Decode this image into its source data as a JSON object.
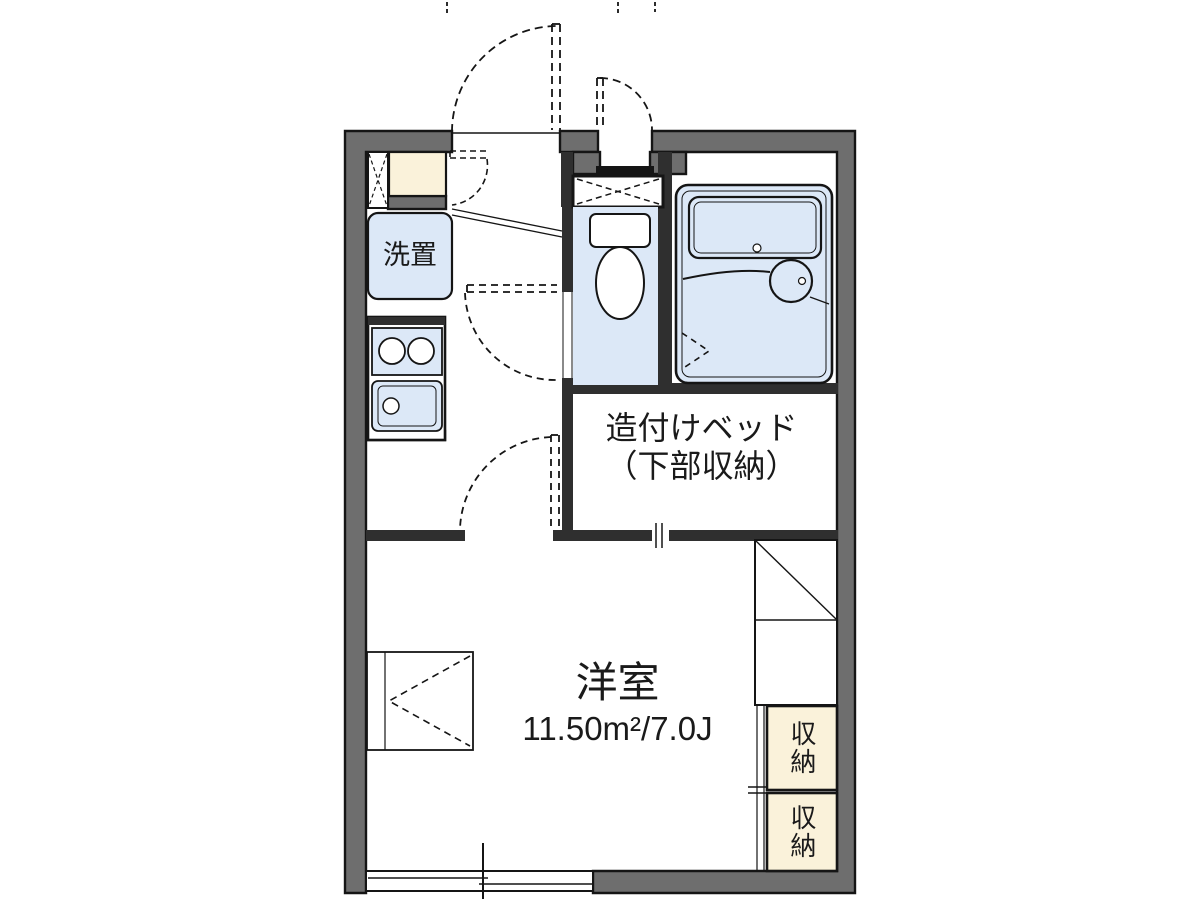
{
  "plan": {
    "type": "apartment-floor-plan",
    "labels": {
      "washer_space": "洗置",
      "built_in_bed_line1": "造付けベッド",
      "built_in_bed_line2": "（下部収納）",
      "main_room_name": "洋室",
      "main_room_area": "11.50m²/7.0J",
      "storage_top": "収納",
      "storage_bottom": "収納"
    },
    "colors": {
      "outer_wall": "#6e6e6e",
      "inner_wall": "#2f2f2f",
      "water_fixture_fill": "#dce8f7",
      "storage_fill": "#faf2da",
      "line": "#151515",
      "background": "#ffffff"
    },
    "fixture_icons": [
      "entrance-door-icon",
      "shoe-cabinet-icon",
      "pipe-space-icon",
      "washing-machine-space-icon",
      "kitchen-stove-icon",
      "kitchen-sink-icon",
      "toilet-icon",
      "bathtub-icon",
      "washbasin-icon",
      "built-in-bed-icon",
      "ladder-box-icon",
      "closet-icon",
      "storage-icon",
      "sliding-window-icon"
    ]
  }
}
